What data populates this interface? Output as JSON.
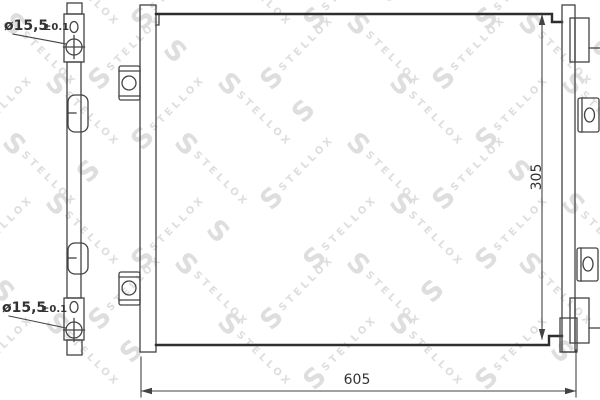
{
  "page": {
    "kind": "technical-drawing",
    "subject": "condenser-front-view"
  },
  "watermark": {
    "brand": "STELLOX",
    "logo_letter": "S",
    "color": "#dedede"
  },
  "dimensions": {
    "hole_top": {
      "value": "ø15,5",
      "tolerance": "±0.1"
    },
    "hole_bottom": {
      "value": "ø15,5",
      "tolerance": "±0.1"
    },
    "core_height": "305",
    "overall_width": "605"
  },
  "colors": {
    "line": "#434343",
    "thick_line": "#2e2e2e",
    "text": "#333333",
    "background": "#ffffff"
  }
}
